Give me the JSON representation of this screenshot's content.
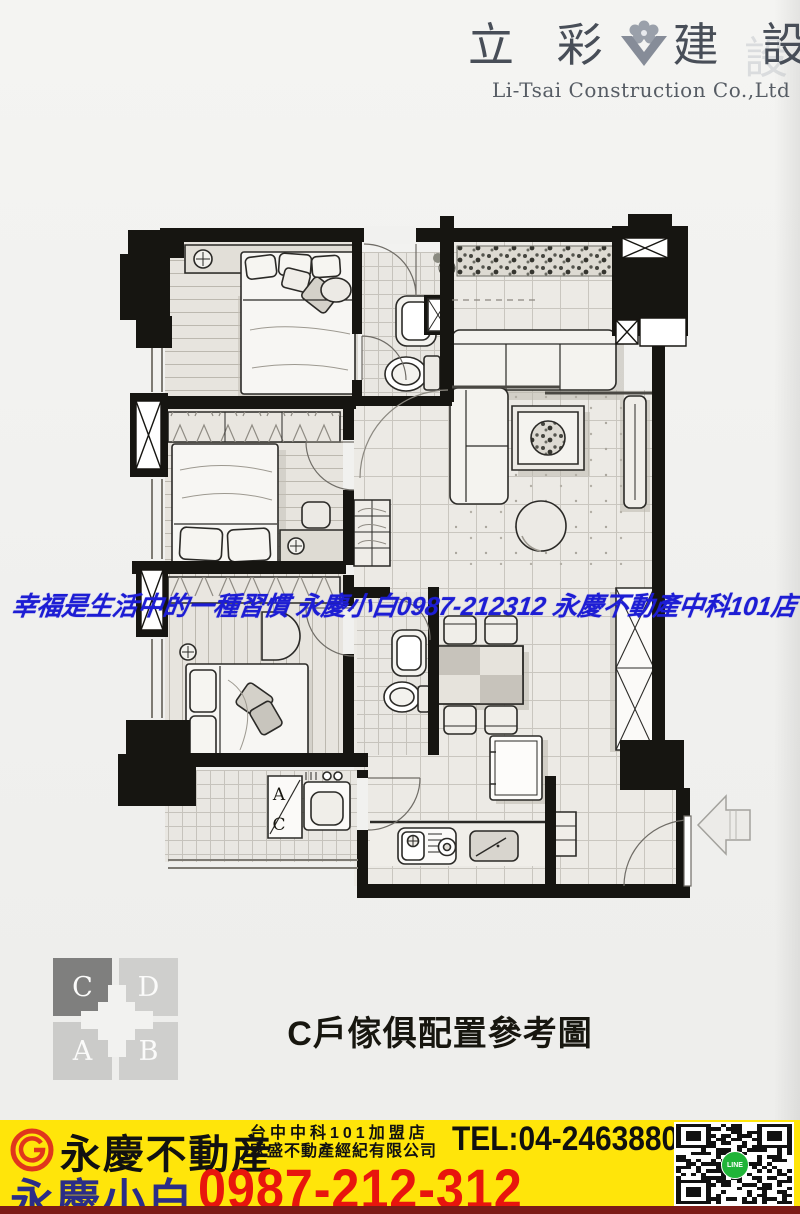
{
  "header": {
    "brand_left": "立 彩",
    "brand_right": "建 設",
    "subtitle": "Li-Tsai Construction Co.,Ltd",
    "ghost_char": "設"
  },
  "watermark": {
    "text": "幸福是生活中的一種習慣 永慶小白0987-212312 永慶不動產中科101店",
    "color": "#1d1dd4"
  },
  "floor_plan": {
    "ac_label_top": "A",
    "ac_label_bottom": "C"
  },
  "unit_key": {
    "cells": [
      {
        "label": "C",
        "color": "#7f7f7e",
        "highlight": true
      },
      {
        "label": "D",
        "color": "#cfcfcd",
        "highlight": false
      },
      {
        "label": "A",
        "color": "#cbcbc9",
        "highlight": false
      },
      {
        "label": "B",
        "color": "#cfcfcd",
        "highlight": false
      }
    ]
  },
  "caption": {
    "text": "C戶傢俱配置參考圖"
  },
  "footer": {
    "bg_color": "#ffe50a",
    "bottom_strip_color": "#7c1b17",
    "brand": "永慶不動産",
    "store_line1": "台中中科101加盟店",
    "store_line2": "家盛不動產經紀有限公司",
    "tel": "TEL:04-24638800",
    "agent": "永慶小白",
    "agent_color": "#2b2d87",
    "phone": "0987-212-312",
    "phone_color": "#e8150d",
    "line_badge": "LINE",
    "logo_color": "#e0361c"
  }
}
